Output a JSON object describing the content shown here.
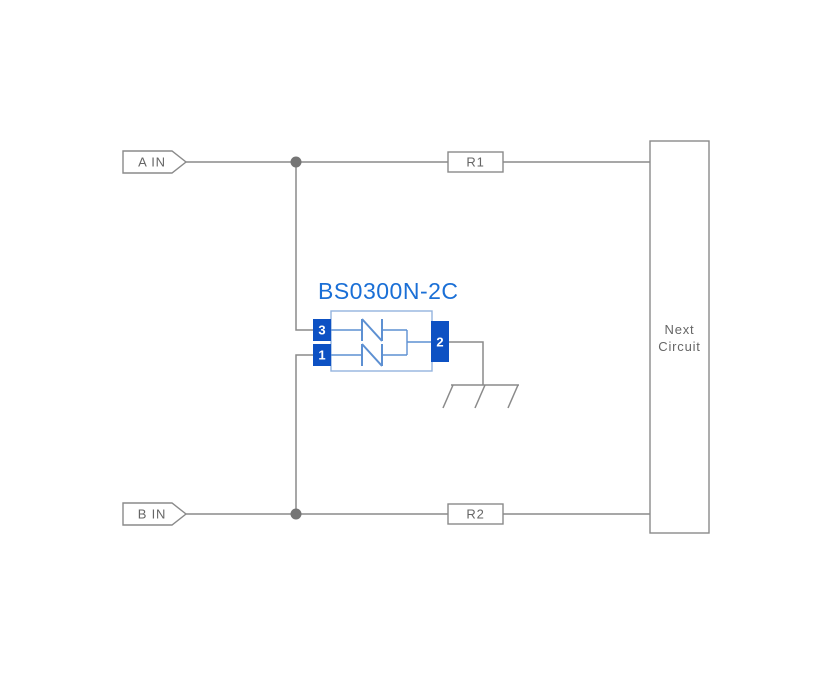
{
  "labels": {
    "input_a": "A IN",
    "input_b": "B IN",
    "resistor_top": "R1",
    "resistor_bottom": "R2",
    "next_circuit_line1": "Next",
    "next_circuit_line2": "Circuit"
  },
  "component": {
    "part_number": "BS0300N-2C",
    "pins": {
      "top_left": "3",
      "bottom_left": "1",
      "right": "2"
    }
  },
  "colors": {
    "background": "#ffffff",
    "wire_gray": "#8a8a8a",
    "label_text": "#666666",
    "junction_dot": "#757575",
    "component_outline": "#93b3de",
    "component_wire": "#5d90d2",
    "pin_fill": "#0d51c3",
    "pin_text": "#ffffff",
    "part_number_text": "#1a6fd6"
  }
}
